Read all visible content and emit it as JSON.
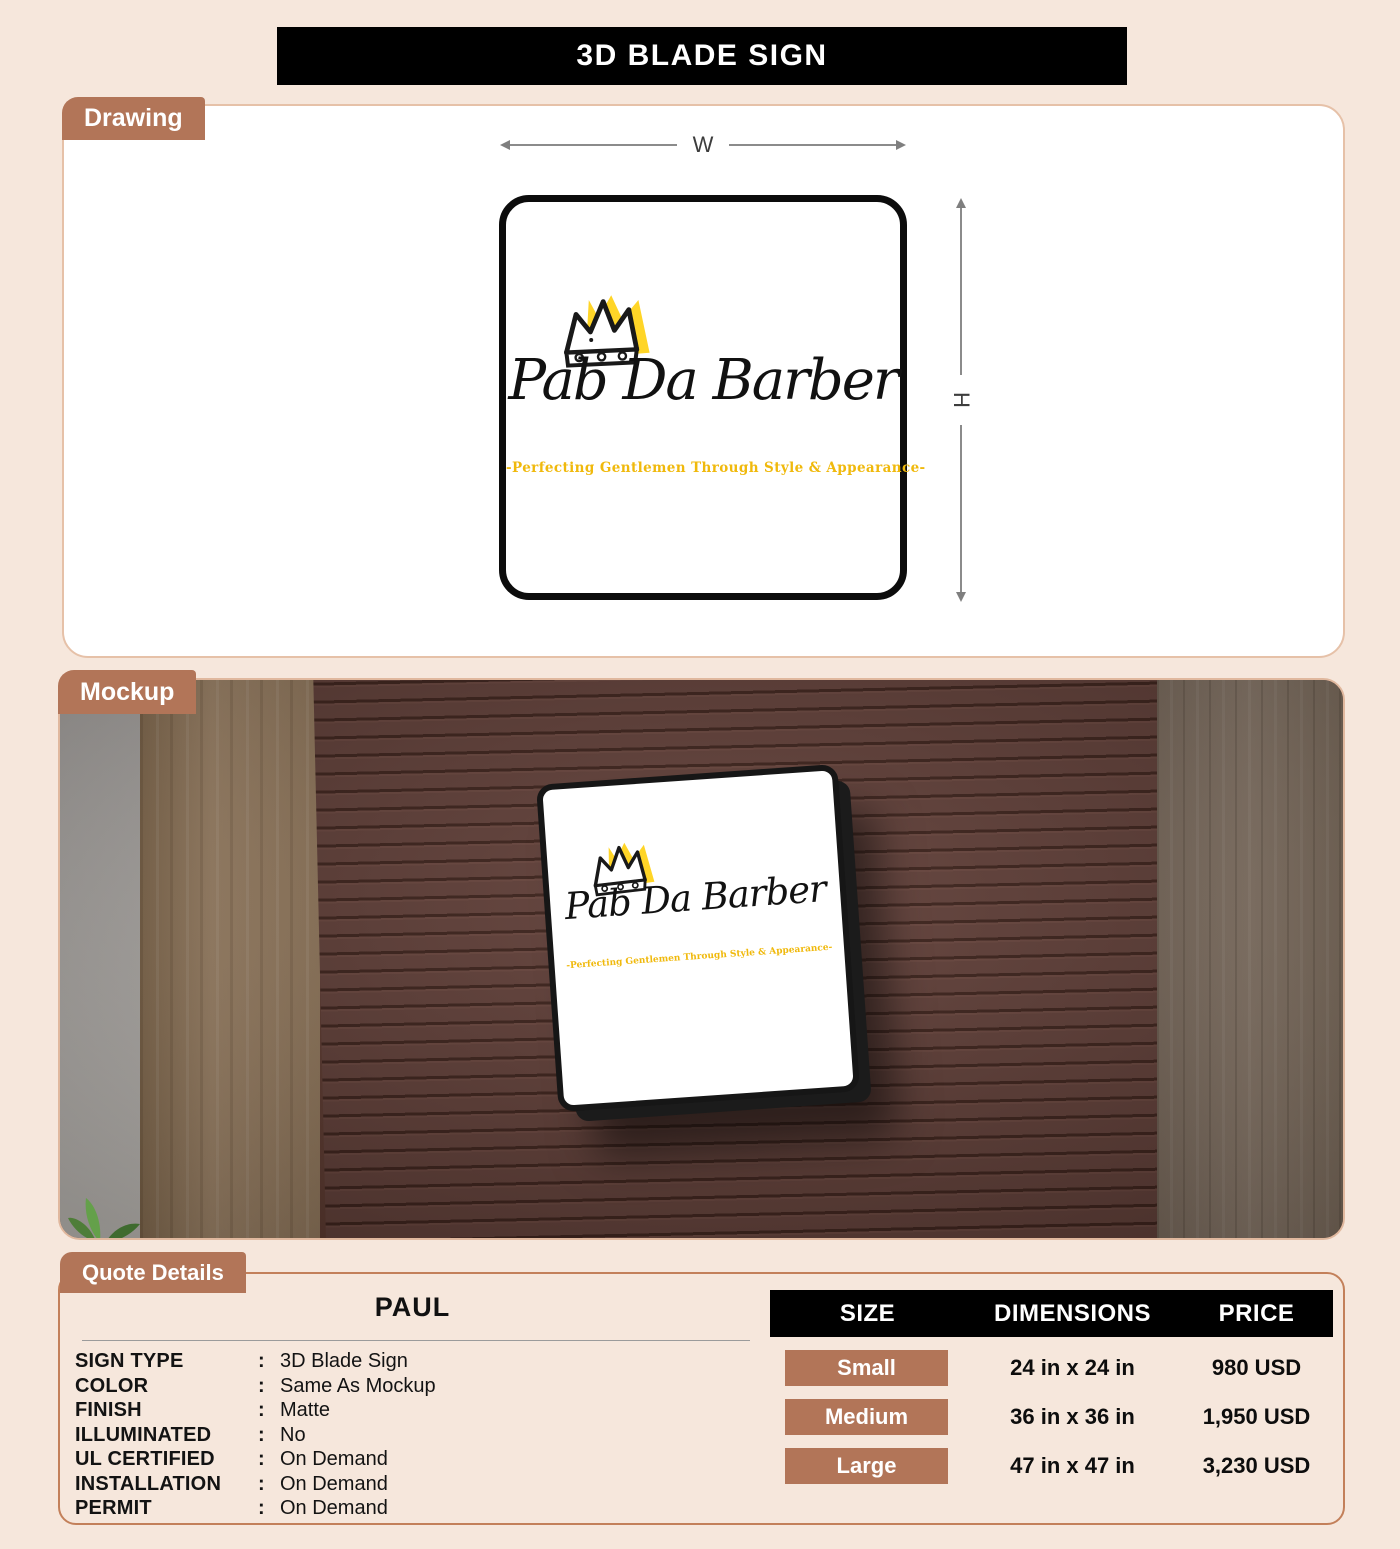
{
  "title": "3D BLADE SIGN",
  "sections": {
    "drawing_tab": "Drawing",
    "mockup_tab": "Mockup",
    "quote_tab": "Quote Details"
  },
  "drawing": {
    "width_label": "W",
    "height_label": "H"
  },
  "logo": {
    "brand": "Pab Da Barber",
    "tagline": "-Perfecting Gentlemen Through Style & Appearance-",
    "crown_icon": "crown-icon"
  },
  "quote": {
    "name": "PAUL",
    "specs": [
      {
        "label": "SIGN TYPE",
        "value": "3D Blade Sign"
      },
      {
        "label": "COLOR",
        "value": "Same As Mockup"
      },
      {
        "label": "FINISH",
        "value": "Matte"
      },
      {
        "label": "ILLUMINATED",
        "value": "No"
      },
      {
        "label": "UL CERTIFIED",
        "value": "On Demand"
      },
      {
        "label": "INSTALLATION",
        "value": "On Demand"
      },
      {
        "label": "PERMIT",
        "value": "On Demand"
      }
    ]
  },
  "table": {
    "headers": [
      "SIZE",
      "DIMENSIONS",
      "PRICE"
    ],
    "rows": [
      {
        "size": "Small",
        "dimensions": "24 in x 24 in",
        "price": "980 USD"
      },
      {
        "size": "Medium",
        "dimensions": "36 in x 36 in",
        "price": "1,950 USD"
      },
      {
        "size": "Large",
        "dimensions": "47 in x 47 in",
        "price": "3,230 USD"
      }
    ]
  },
  "colors": {
    "accent_brown": "#b27558",
    "page_background": "#f6e7dc",
    "title_bar": "#000000",
    "crown_yellow": "#ffd527",
    "tagline_gold": "#f0b90c",
    "wall_brown": "#5e3b31"
  }
}
